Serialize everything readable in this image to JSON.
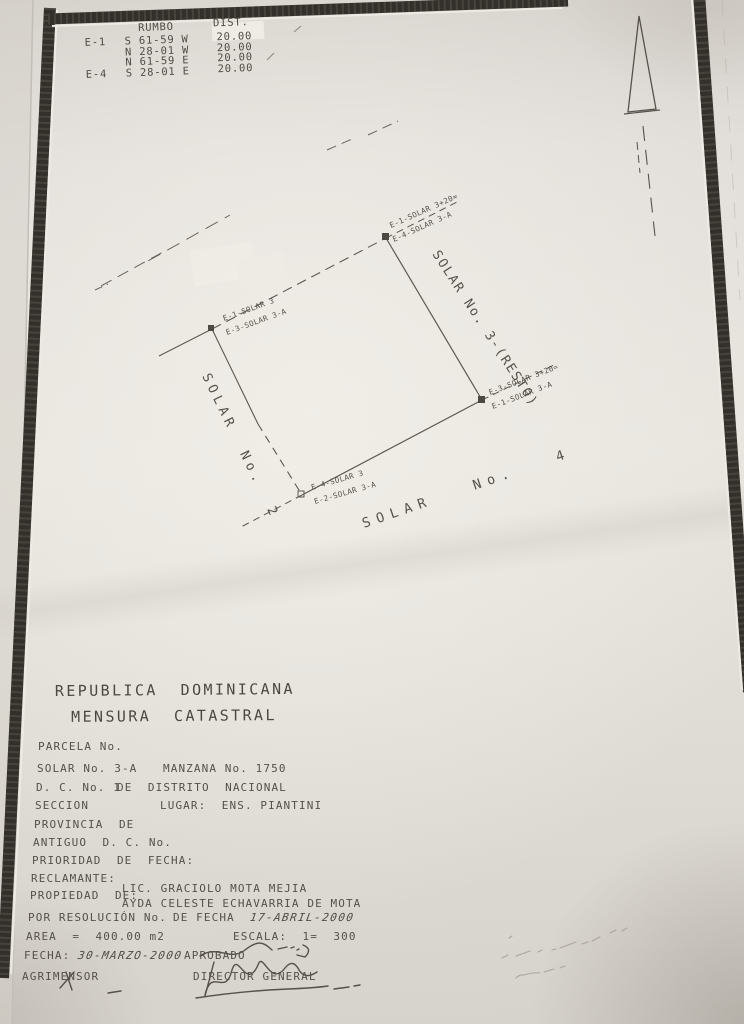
{
  "document": {
    "country_title": "REPUBLICA  DOMINICANA",
    "doc_title": "MENSURA  CATASTRAL"
  },
  "bearings_table": {
    "col_rumbo": "RUMBO",
    "col_dist": "DIST.",
    "rows": [
      {
        "station": "E-1",
        "rumbo": "S 61-59 W",
        "dist": "20.00"
      },
      {
        "station": "",
        "rumbo": "N 28-01 W",
        "dist": "20.00"
      },
      {
        "station": "",
        "rumbo": "N 61-59 E",
        "dist": "20.00"
      },
      {
        "station": "E-4",
        "rumbo": "S 28-01 E",
        "dist": "20.00"
      }
    ]
  },
  "plot": {
    "corners": {
      "top": {
        "line1": "E-1-SOLAR 3+20=",
        "line2": "E-4-SOLAR 3-A"
      },
      "left": {
        "line1": "E-1-SOLAR 3",
        "line2": "E-3-SOLAR 3-A"
      },
      "right": {
        "line1": "E-3-SOLAR 3+20=",
        "line2": "E-1-SOLAR 3-A"
      },
      "bottom": {
        "line1": "E-4-SOLAR 3",
        "line2": "E-2-SOLAR 3-A"
      }
    },
    "adjacent": {
      "left": "SOLAR  No.  2",
      "right": "SOLAR No. 3-(RESTO)",
      "bottom": "SOLAR   No.   4"
    },
    "icons": {
      "north": "north-arrow"
    }
  },
  "form": {
    "parcela": "PARCELA No.",
    "solar": "SOLAR No. 3-A",
    "manzana": "MANZANA No. 1750",
    "dc": "D. C. No. 1",
    "distrito": "DE  DISTRITO  NACIONAL",
    "seccion": "SECCION",
    "lugar": "LUGAR:  ENS. PIANTINI",
    "provincia": "PROVINCIA  DE",
    "antiguo": "ANTIGUO  D. C. No.",
    "prioridad": "PRIORIDAD  DE  FECHA:",
    "reclamante": "RECLAMANTE:",
    "propiedad": "PROPIEDAD  DE:",
    "propietario1": "LIC. GRACIOLO MOTA MEJIA",
    "propietario2": "AYDA CELESTE ECHAVARRIA DE MOTA",
    "resolucion": "POR RESOLUCIÓN No.",
    "de_fecha": "DE FECHA",
    "fecha_resolucion": "17-ABRIL-2000",
    "area": "AREA  =  400.00 m2",
    "escala": "ESCALA:  1=  300",
    "fecha_label": "FECHA:",
    "fecha_valor": "30-MARZO-2000",
    "aprobado": "APROBADO",
    "agrimensor": "AGRIMENSOR",
    "director": "DIRECTOR GENERAL"
  },
  "colors": {
    "paper": "#e5e1db",
    "ink": "#53504b",
    "frame": "#33302b"
  }
}
